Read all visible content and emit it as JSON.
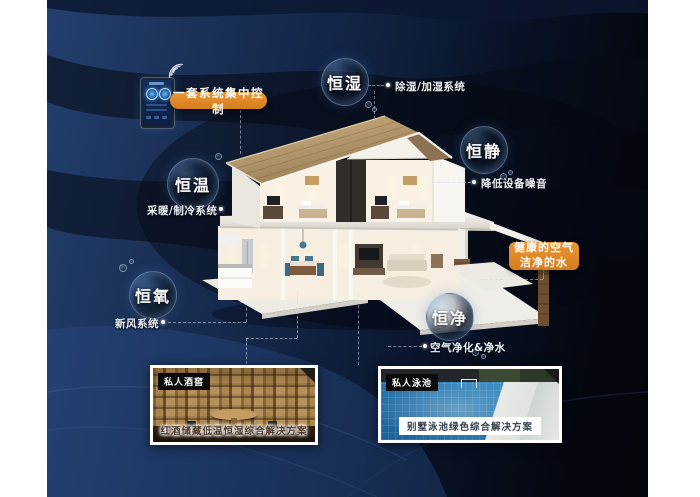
{
  "scene": {
    "control": {
      "label": "一套系统集中控制",
      "icon": "wifi-icon"
    },
    "bubbles": [
      {
        "label": "恒湿",
        "desc": "除湿/加湿系统"
      },
      {
        "label": "恒静",
        "desc": "降低设备噪音"
      },
      {
        "label": "恒温",
        "desc": "采暖/制冷系统"
      },
      {
        "label": "恒氧",
        "desc": "新风系统"
      },
      {
        "label": "恒净",
        "desc": "空气净化&净水"
      }
    ],
    "highlight": {
      "line1": "健康的空气",
      "line2": "洁净的水"
    },
    "photos": [
      {
        "tag": "私人酒窖",
        "caption": "红酒储藏低温恒湿综合解决方案"
      },
      {
        "tag": "私人泳池",
        "caption": "别墅泳池绿色综合解决方案"
      }
    ],
    "colors": {
      "accent_orange": "#DD8526",
      "navy": "#1E3A68",
      "background_dark": "#05080F",
      "bubble_rim": "#AFCDF0"
    }
  }
}
